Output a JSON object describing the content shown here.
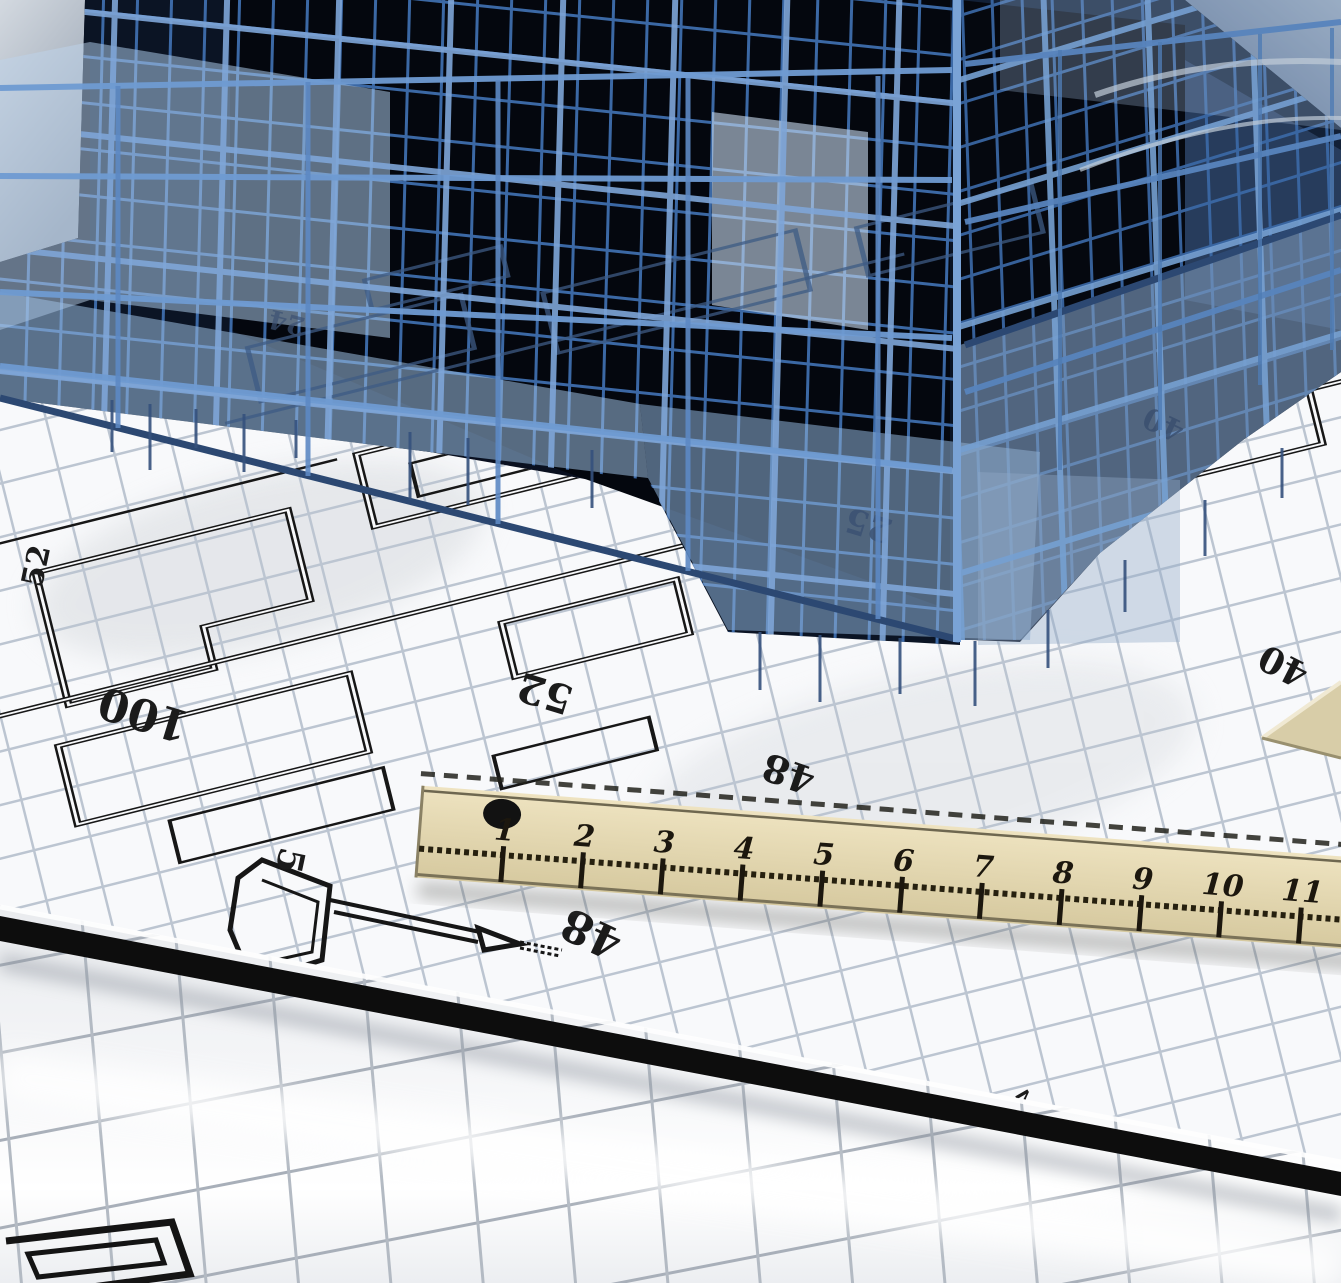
{
  "scene": {
    "subject": "3D wireframe building model standing on rolled architectural blueprints with a wooden ruler"
  },
  "ruler": {
    "unit_labels": [
      "1",
      "2",
      "3",
      "4",
      "5",
      "6",
      "7",
      "8",
      "9",
      "10",
      "11"
    ]
  },
  "blueprint": {
    "dimension_labels": [
      "52",
      "100",
      "52",
      "48",
      "40",
      "5",
      "48",
      "2"
    ],
    "faint_labels": [
      "25",
      "40",
      "24"
    ]
  },
  "palette": {
    "paper": "#f8f9fb",
    "grid_line": "#bcc5d1",
    "plan_ink": "#171717",
    "building_blue": "#4273b5",
    "building_blue_light": "#7fa6d8",
    "building_dark": "#0b1424",
    "glass_blue": "#a9c6e6",
    "ruler_wood": "#e0d5b2",
    "ruler_ink": "#1c170e",
    "band_black": "#0d0d0d",
    "roll_shadow": "#8b929c"
  }
}
